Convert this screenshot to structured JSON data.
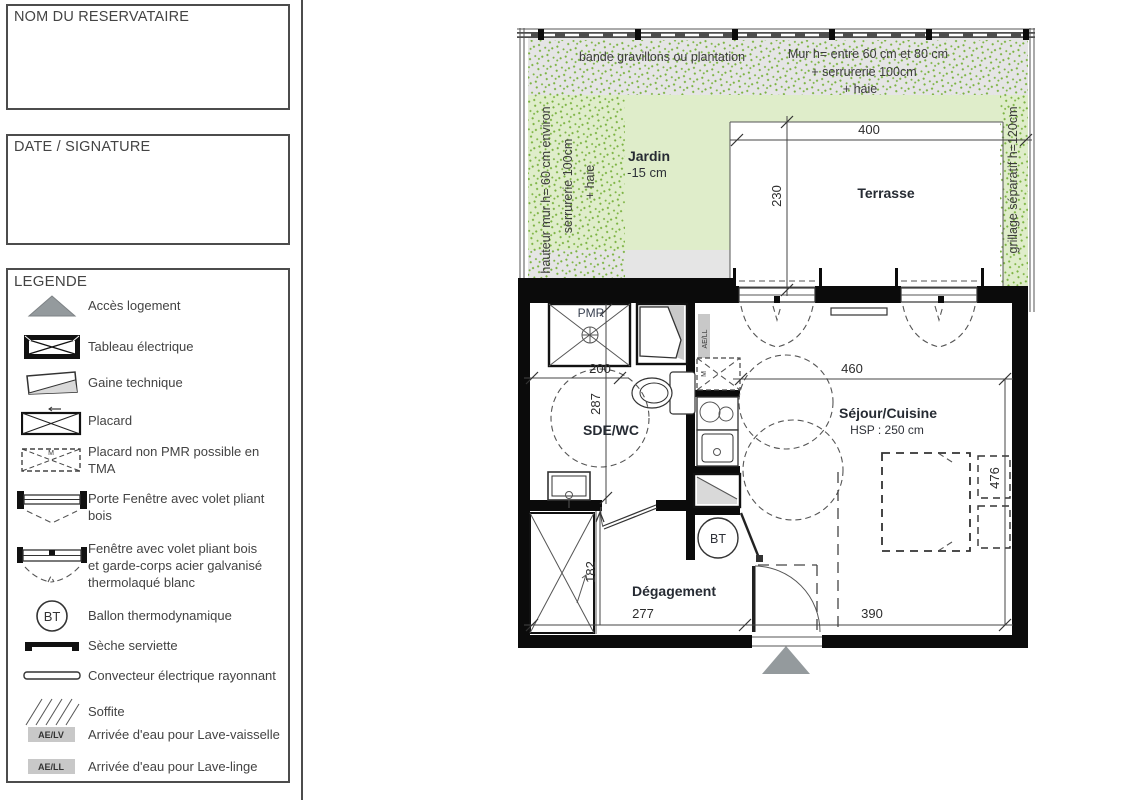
{
  "panel": {
    "reservataire_label": "NOM DU RESERVATAIRE",
    "date_label": "DATE / SIGNATURE",
    "legend_title": "LEGENDE",
    "legend_items": [
      {
        "icon": "access-triangle-icon",
        "label": "Accès logement"
      },
      {
        "icon": "electrical-panel-icon",
        "label": "Tableau électrique"
      },
      {
        "icon": "technical-duct-icon",
        "label": "Gaine technique"
      },
      {
        "icon": "closet-icon",
        "label": "Placard"
      },
      {
        "icon": "closet-non-pmr-icon",
        "label": "Placard non PMR possible en TMA",
        "mark": "M"
      },
      {
        "icon": "french-door-icon",
        "label": "Porte Fenêtre avec volet pliant bois"
      },
      {
        "icon": "window-icon",
        "label": "Fenêtre avec volet pliant bois\net garde-corps acier galvanisé\nthermolaqué blanc"
      },
      {
        "icon": "bt-circle-icon",
        "label": "Ballon thermodynamique",
        "badge": "BT"
      },
      {
        "icon": "towel-dryer-icon",
        "label": "Sèche serviette"
      },
      {
        "icon": "convector-icon",
        "label": "Convecteur électrique rayonnant"
      },
      {
        "icon": "soffit-icon",
        "label": "Soffite"
      },
      {
        "icon": "water-inlet-lv-icon",
        "label": "Arrivée d'eau pour Lave-vaisselle",
        "badge": "AE/LV"
      },
      {
        "icon": "water-inlet-ll-icon",
        "label": "Arrivée d'eau pour Lave-linge",
        "badge": "AE/LL"
      }
    ]
  },
  "plan": {
    "garden": {
      "label": "Jardin",
      "level": "-15 cm",
      "gravel_note": "bande gravillons ou plantation",
      "wall_note_top1": "Mur h= entre 60 cm et 80 cm",
      "wall_note_top2": "+ serrurerie 100cm",
      "wall_note_top3": "+ haie",
      "side_note1": "hauteur mur h= 60 cm environ",
      "side_note2": "serrurerie 100cm",
      "side_note3": "+ haie",
      "fence_note": "grillage séparatif h=120cm"
    },
    "rooms": {
      "terrace": "Terrasse",
      "bathroom": "SDE/WC",
      "living": "Séjour/Cuisine",
      "living_height": "HSP : 250 cm",
      "hallway": "Dégagement"
    },
    "annotations": {
      "pmr": "PMR",
      "bt": "BT",
      "ae_ll": "AE/LL",
      "closet_mark": "M"
    },
    "dimensions": {
      "terrace_width": "400",
      "terrace_depth": "230",
      "bathroom_width": "200",
      "bathroom_depth": "287",
      "living_width": "460",
      "living_depth": "476",
      "hallway_width": "277",
      "hallway_depth": "182",
      "entry_width": "390"
    }
  },
  "colors": {
    "garden_green": "#dfedca",
    "speckle_green": "#7cb342",
    "gravel_gray": "#e5e5e5",
    "wall_black": "#0b0b0b",
    "triangle_gray": "#949a9d",
    "badge_gray": "#c8c8c8"
  }
}
